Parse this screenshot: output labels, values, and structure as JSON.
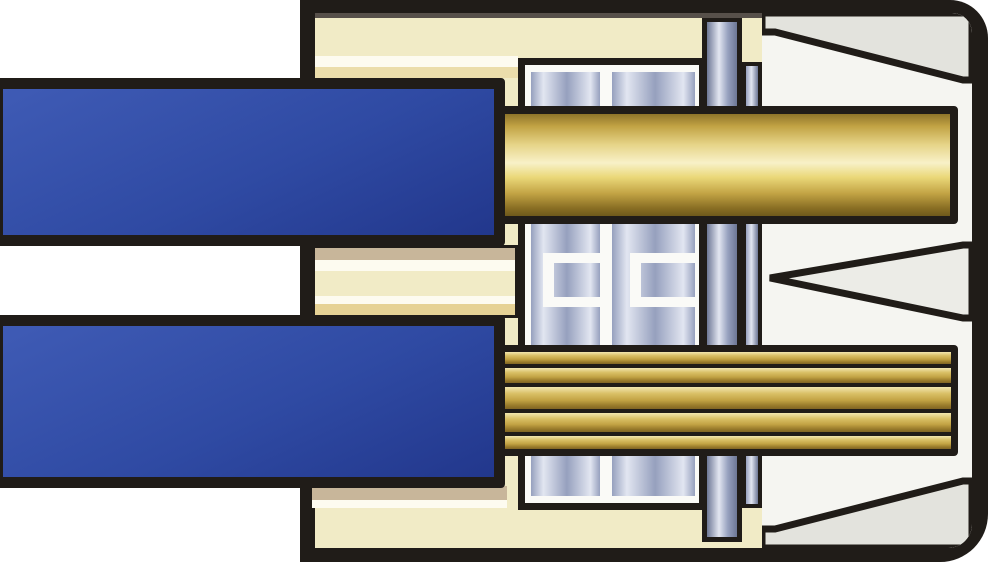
{
  "illustration": {
    "description": "Cross-section diagram of a push-in connector terminal: a solid-core wire (top) and a stranded wire (bottom) with blue insulation enter a cream plastic housing and are held by a metallic spring clamp block with a release pin; conductors are gold.",
    "parts": {
      "housing": "connector housing",
      "wire_top": "solid-core wire with blue insulation",
      "wire_bottom": "stranded wire with blue insulation",
      "conductor_top": "solid gold conductor",
      "conductor_bottom": "stranded gold conductor",
      "clamp": "spring clamp block",
      "release_pin": "release pin",
      "clamp_bar": "clamp bar",
      "funnel_top": "upper housing funnel",
      "funnel_middle": "middle guide wedge",
      "funnel_bottom": "lower housing funnel",
      "divider": "housing divider tongue"
    },
    "strand_count": 5,
    "colors": {
      "outline": "#201c18",
      "housing_cream": "#f1ebc6",
      "housing_cream_dark": "#e6d295",
      "housing_tan": "#c8b69a",
      "stripe_white": "#fdfbf0",
      "cavity_white": "#f5f5f1",
      "funnel_gray": "#e3e3dd",
      "funnel_gray_light": "#ecece7",
      "insulation_blue": "#2f4aa3",
      "insulation_blue_light": "#3f5bb5",
      "insulation_blue_dark": "#22378c",
      "conductor_gold": "#d9c066",
      "conductor_gold_pale": "#f8f1c8",
      "conductor_gold_mid": "#c2a344",
      "conductor_gold_dark": "#6e591c",
      "metal_light": "#e2e6f1",
      "metal_mid": "#96a0be",
      "metal_dark": "#6d7795",
      "frame_white": "#fafaf7",
      "inner_shadow": "#57504a"
    }
  }
}
